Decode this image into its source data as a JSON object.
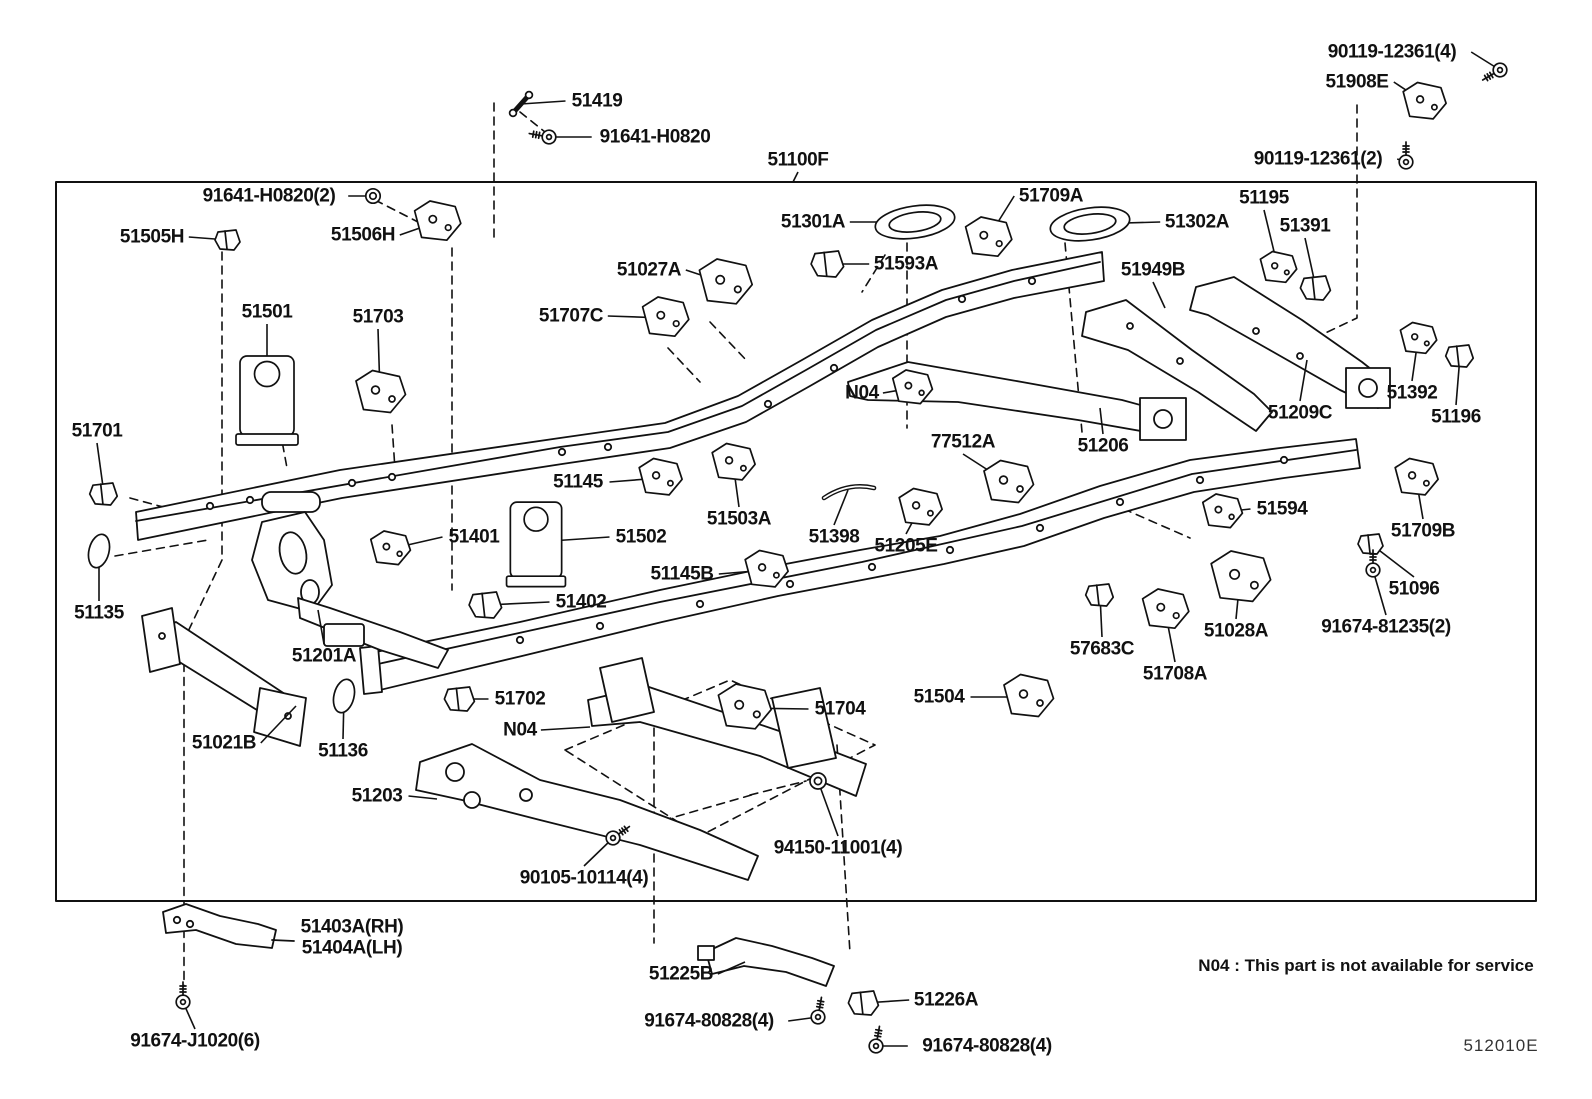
{
  "diagram": {
    "code": "512010E",
    "service_note": "N04 : This part is not available for service",
    "colors": {
      "line": "#111111",
      "background": "#ffffff"
    },
    "parts": [
      {
        "id": "51419",
        "label": "51419",
        "x": 597,
        "y": 101,
        "lx": 521,
        "ly": 104,
        "glyph": "link"
      },
      {
        "id": "91641-h0820",
        "label": "91641-H0820",
        "x": 655,
        "y": 137,
        "lx": 549,
        "ly": 137,
        "glyph": "bolt",
        "gr": 190
      },
      {
        "id": "51100f",
        "label": "51100F",
        "x": 798,
        "y": 160,
        "lx": 793,
        "ly": 182,
        "glyph": "none"
      },
      {
        "id": "90119-12361-4",
        "label": "90119-12361(4)",
        "x": 1392,
        "y": 52,
        "lx": 1500,
        "ly": 70,
        "glyph": "bolt",
        "gr": 150
      },
      {
        "id": "51908e",
        "label": "51908E",
        "x": 1357,
        "y": 82,
        "lx": 1424,
        "ly": 102,
        "glyph": "bracket",
        "gs": 1.3
      },
      {
        "id": "90119-12361-2",
        "label": "90119-12361(2)",
        "x": 1318,
        "y": 159,
        "lx": 1406,
        "ly": 162,
        "glyph": "bolt",
        "gr": -90
      },
      {
        "id": "91641-h0820-2",
        "label": "91641-H0820(2)",
        "x": 269,
        "y": 196,
        "lx": 373,
        "ly": 196,
        "glyph": "nut",
        "gs": 0.9
      },
      {
        "id": "51505h",
        "label": "51505H",
        "x": 152,
        "y": 237,
        "lx": 228,
        "ly": 240,
        "glyph": "clip"
      },
      {
        "id": "51506h",
        "label": "51506H",
        "x": 363,
        "y": 235,
        "lx": 437,
        "ly": 222,
        "glyph": "bracket",
        "gs": 1.4
      },
      {
        "id": "51301a",
        "label": "51301A",
        "x": 813,
        "y": 222,
        "lx": 915,
        "ly": 222,
        "glyph": "pan"
      },
      {
        "id": "51709a",
        "label": "51709A",
        "x": 1051,
        "y": 196,
        "lx": 988,
        "ly": 238,
        "glyph": "bracket",
        "gs": 1.4
      },
      {
        "id": "51593a",
        "label": "51593A",
        "x": 906,
        "y": 264,
        "lx": 828,
        "ly": 264,
        "glyph": "clip",
        "gs": 1.3
      },
      {
        "id": "51302a",
        "label": "51302A",
        "x": 1197,
        "y": 222,
        "lx": 1090,
        "ly": 224,
        "glyph": "pan"
      },
      {
        "id": "51195",
        "label": "51195",
        "x": 1264,
        "y": 198,
        "lx": 1278,
        "ly": 268,
        "glyph": "bracket",
        "gs": 1.1
      },
      {
        "id": "51391",
        "label": "51391",
        "x": 1305,
        "y": 226,
        "lx": 1316,
        "ly": 288,
        "glyph": "clip",
        "gs": 1.2
      },
      {
        "id": "51027a",
        "label": "51027A",
        "x": 649,
        "y": 270,
        "lx": 725,
        "ly": 283,
        "glyph": "bracket",
        "gs": 1.6
      },
      {
        "id": "51707c",
        "label": "51707C",
        "x": 571,
        "y": 316,
        "lx": 665,
        "ly": 318,
        "glyph": "bracket",
        "gs": 1.4
      },
      {
        "id": "51949b",
        "label": "51949B",
        "x": 1153,
        "y": 270,
        "lx": 1165,
        "ly": 308,
        "glyph": "none"
      },
      {
        "id": "51501",
        "label": "51501",
        "x": 267,
        "y": 312,
        "lx": 267,
        "ly": 398,
        "glyph": "tower"
      },
      {
        "id": "51703",
        "label": "51703",
        "x": 378,
        "y": 317,
        "lx": 380,
        "ly": 393,
        "glyph": "bracket",
        "gs": 1.5
      },
      {
        "id": "51392",
        "label": "51392",
        "x": 1412,
        "y": 393,
        "lx": 1418,
        "ly": 339,
        "glyph": "bracket",
        "gs": 1.1
      },
      {
        "id": "51196",
        "label": "51196",
        "x": 1456,
        "y": 417,
        "lx": 1460,
        "ly": 356,
        "glyph": "clip",
        "gs": 1.1
      },
      {
        "id": "51209c",
        "label": "51209C",
        "x": 1300,
        "y": 413,
        "lx": 1307,
        "ly": 360,
        "glyph": "none"
      },
      {
        "id": "51701",
        "label": "51701",
        "x": 97,
        "y": 431,
        "lx": 104,
        "ly": 494,
        "glyph": "clip",
        "gs": 1.1
      },
      {
        "id": "n04-1",
        "label": "N04",
        "x": 862,
        "y": 393,
        "lx": 912,
        "ly": 388,
        "glyph": "bracket",
        "gs": 1.2
      },
      {
        "id": "77512a",
        "label": "77512A",
        "x": 963,
        "y": 442,
        "lx": 1008,
        "ly": 483,
        "glyph": "bracket",
        "gs": 1.5
      },
      {
        "id": "51206",
        "label": "51206",
        "x": 1103,
        "y": 446,
        "lx": 1100,
        "ly": 408,
        "glyph": "none"
      },
      {
        "id": "51145",
        "label": "51145",
        "x": 578,
        "y": 482,
        "lx": 660,
        "ly": 478,
        "glyph": "bracket",
        "gs": 1.3
      },
      {
        "id": "51503a",
        "label": "51503A",
        "x": 739,
        "y": 519,
        "lx": 733,
        "ly": 463,
        "glyph": "bracket",
        "gs": 1.3
      },
      {
        "id": "51398",
        "label": "51398",
        "x": 834,
        "y": 537,
        "lx": 848,
        "ly": 490,
        "glyph": "rod"
      },
      {
        "id": "51594",
        "label": "51594",
        "x": 1282,
        "y": 509,
        "lx": 1222,
        "ly": 512,
        "glyph": "bracket",
        "gs": 1.2
      },
      {
        "id": "51709b",
        "label": "51709B",
        "x": 1423,
        "y": 531,
        "lx": 1416,
        "ly": 478,
        "glyph": "bracket",
        "gs": 1.3
      },
      {
        "id": "51401",
        "label": "51401",
        "x": 474,
        "y": 537,
        "lx": 390,
        "ly": 549,
        "glyph": "bracket",
        "gs": 1.2
      },
      {
        "id": "51502",
        "label": "51502",
        "x": 641,
        "y": 537,
        "lx": 536,
        "ly": 542,
        "glyph": "tower",
        "gs": 0.95
      },
      {
        "id": "51205e",
        "label": "51205E",
        "x": 906,
        "y": 546,
        "lx": 920,
        "ly": 508,
        "glyph": "bracket",
        "gs": 1.3
      },
      {
        "id": "51135",
        "label": "51135",
        "x": 99,
        "y": 613,
        "lx": 99,
        "ly": 551,
        "glyph": "oval"
      },
      {
        "id": "51145b",
        "label": "51145B",
        "x": 682,
        "y": 574,
        "lx": 766,
        "ly": 570,
        "glyph": "bracket",
        "gs": 1.3
      },
      {
        "id": "51096",
        "label": "51096",
        "x": 1414,
        "y": 589,
        "lx": 1371,
        "ly": 544,
        "glyph": "clip"
      },
      {
        "id": "51402",
        "label": "51402",
        "x": 581,
        "y": 602,
        "lx": 486,
        "ly": 605,
        "glyph": "clip",
        "gs": 1.3
      },
      {
        "id": "91674-81235-2",
        "label": "91674-81235(2)",
        "x": 1386,
        "y": 627,
        "lx": 1373,
        "ly": 570,
        "glyph": "bolt",
        "gr": -90
      },
      {
        "id": "51201a",
        "label": "51201A",
        "x": 324,
        "y": 656,
        "lx": 318,
        "ly": 610,
        "glyph": "none"
      },
      {
        "id": "57683c",
        "label": "57683C",
        "x": 1102,
        "y": 649,
        "lx": 1100,
        "ly": 595,
        "glyph": "clip",
        "gs": 1.1
      },
      {
        "id": "51028a",
        "label": "51028A",
        "x": 1236,
        "y": 631,
        "lx": 1240,
        "ly": 578,
        "glyph": "bracket",
        "gs": 1.8
      },
      {
        "id": "51708a",
        "label": "51708A",
        "x": 1175,
        "y": 674,
        "lx": 1165,
        "ly": 610,
        "glyph": "bracket",
        "gs": 1.4
      },
      {
        "id": "51702",
        "label": "51702",
        "x": 520,
        "y": 699,
        "lx": 460,
        "ly": 699,
        "glyph": "clip",
        "gs": 1.2
      },
      {
        "id": "51021b",
        "label": "51021B",
        "x": 224,
        "y": 743,
        "lx": 296,
        "ly": 706,
        "glyph": "none"
      },
      {
        "id": "n04-2",
        "label": "N04",
        "x": 520,
        "y": 730,
        "lx": 590,
        "ly": 727,
        "glyph": "none"
      },
      {
        "id": "51704",
        "label": "51704",
        "x": 840,
        "y": 709,
        "lx": 744,
        "ly": 708,
        "glyph": "bracket",
        "gs": 1.6
      },
      {
        "id": "51504",
        "label": "51504",
        "x": 939,
        "y": 697,
        "lx": 1028,
        "ly": 697,
        "glyph": "bracket",
        "gs": 1.5
      },
      {
        "id": "51136",
        "label": "51136",
        "x": 343,
        "y": 751,
        "lx": 344,
        "ly": 696,
        "glyph": "oval"
      },
      {
        "id": "51203",
        "label": "51203",
        "x": 377,
        "y": 796,
        "lx": 437,
        "ly": 799,
        "glyph": "none"
      },
      {
        "id": "94150-11001-4",
        "label": "94150-11001(4)",
        "x": 838,
        "y": 848,
        "lx": 818,
        "ly": 781,
        "glyph": "nut"
      },
      {
        "id": "90105-10114-4",
        "label": "90105-10114(4)",
        "x": 584,
        "y": 878,
        "lx": 613,
        "ly": 838,
        "glyph": "bolt",
        "gr": -35
      },
      {
        "id": "51403a-rh",
        "label": "51403A(RH)",
        "x": 352,
        "y": 927,
        "glyph": "none"
      },
      {
        "id": "51404a-lh",
        "label": "51404A(LH)",
        "x": 352,
        "y": 948,
        "glyph": "none"
      },
      {
        "id": "91674-j1020-6",
        "label": "91674-J1020(6)",
        "x": 195,
        "y": 1041,
        "lx": 183,
        "ly": 1002,
        "glyph": "bolt",
        "gr": -90
      },
      {
        "id": "51225b",
        "label": "51225B",
        "x": 681,
        "y": 974,
        "lx": 745,
        "ly": 962,
        "glyph": "none"
      },
      {
        "id": "91674-80828-4-a",
        "label": "91674-80828(4)",
        "x": 709,
        "y": 1021,
        "lx": 818,
        "ly": 1017,
        "glyph": "bolt",
        "gr": -80
      },
      {
        "id": "51226a",
        "label": "51226A",
        "x": 946,
        "y": 1000,
        "lx": 864,
        "ly": 1003,
        "glyph": "clip",
        "gs": 1.2
      },
      {
        "id": "91674-80828-4-b",
        "label": "91674-80828(4)",
        "x": 987,
        "y": 1046,
        "lx": 876,
        "ly": 1046,
        "glyph": "bolt",
        "gr": -80
      }
    ]
  }
}
